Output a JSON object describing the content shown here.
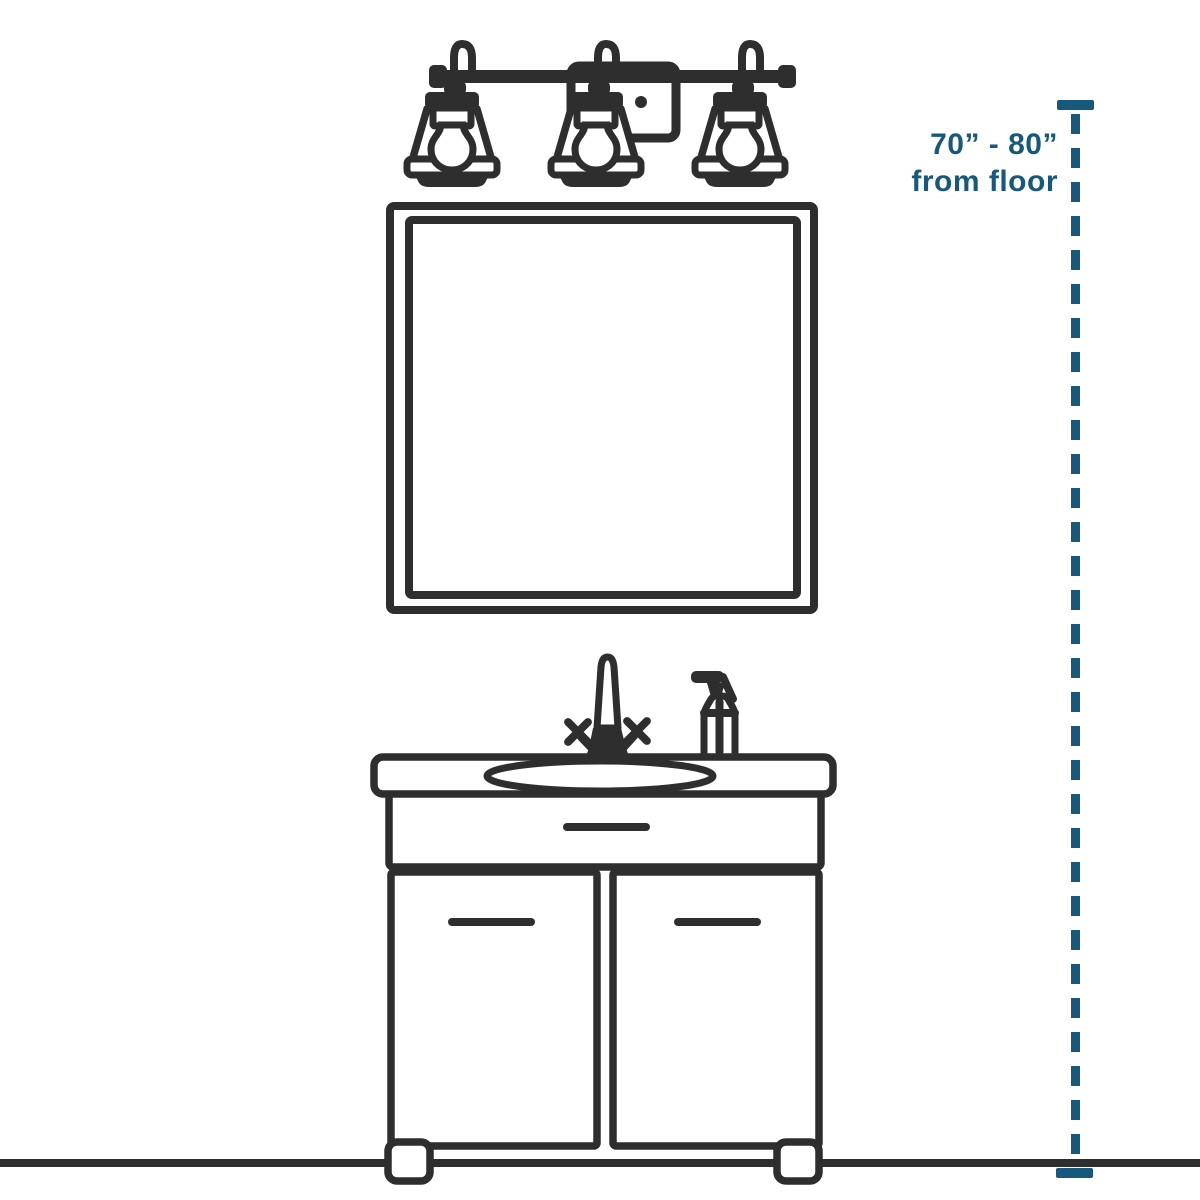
{
  "figure": {
    "annotation": {
      "height_range": "70” - 80”",
      "reference": "from floor"
    },
    "colors": {
      "line_art": "#2e2e2e",
      "measurement_accent": "#17587d",
      "background": "#ffffff"
    },
    "icons": [
      {
        "name": "vanity-light-icon",
        "meaning": "three-light bath vanity fixture"
      },
      {
        "name": "mirror-icon",
        "meaning": "square wall mirror"
      },
      {
        "name": "faucet-icon",
        "meaning": "two-handle sink faucet"
      },
      {
        "name": "soap-dispenser-icon",
        "meaning": "pump soap bottle"
      },
      {
        "name": "vanity-cabinet-icon",
        "meaning": "two-door vanity cabinet with drawer and oval sink"
      },
      {
        "name": "floor-line",
        "meaning": "floor reference line"
      },
      {
        "name": "measurement-line",
        "meaning": "vertical dashed dimension line with end caps"
      }
    ]
  }
}
